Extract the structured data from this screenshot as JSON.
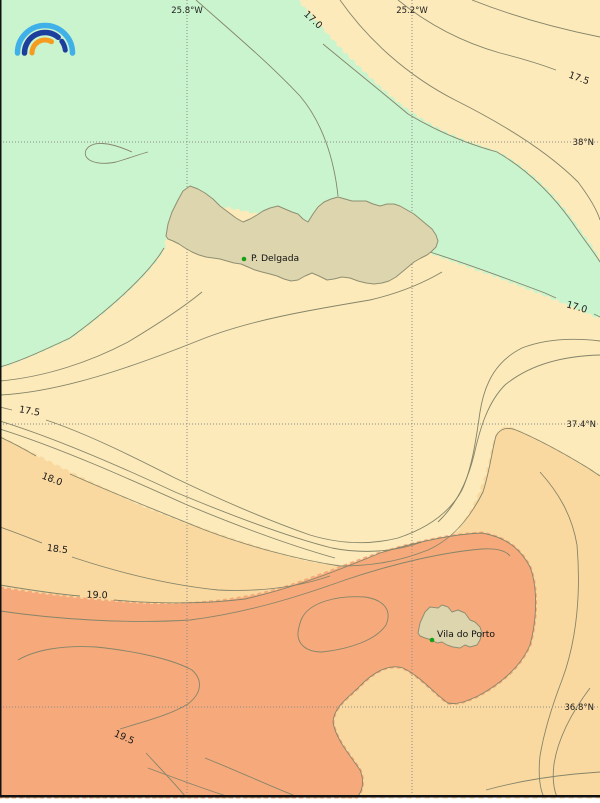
{
  "grid": {
    "meridians": [
      {
        "label": "25.8°W"
      },
      {
        "label": "25.2°W"
      }
    ],
    "parallels": [
      {
        "label": "38°N"
      },
      {
        "label": "37.4°N"
      },
      {
        "label": "36.8°N"
      }
    ]
  },
  "isolines": {
    "unit": "",
    "labels": [
      {
        "value": "17.0"
      },
      {
        "value": "17.5"
      },
      {
        "value": "17.0"
      },
      {
        "value": "17.5"
      },
      {
        "value": "18.0"
      },
      {
        "value": "18.5"
      },
      {
        "value": "19.0"
      },
      {
        "value": "19.5"
      }
    ]
  },
  "places": [
    {
      "name": "P. Delgada"
    },
    {
      "name": "Vila do Porto"
    }
  ],
  "colors": {
    "band_lt_17": "#c9f4cd",
    "band_17_18": "#fdeaba",
    "band_18_19": "#fad9a0",
    "band_gt_19": "#f6a97a",
    "land": "#ddd5ad",
    "land_stroke": "#8f8f73",
    "contour": "#85856a",
    "grid_line": "#8a8a8a",
    "frame": "#111111",
    "place_dot": "#15a015",
    "logo_light_blue": "#3fb0e8",
    "logo_dark_blue": "#1c3e9c",
    "logo_orange": "#f59b20"
  }
}
